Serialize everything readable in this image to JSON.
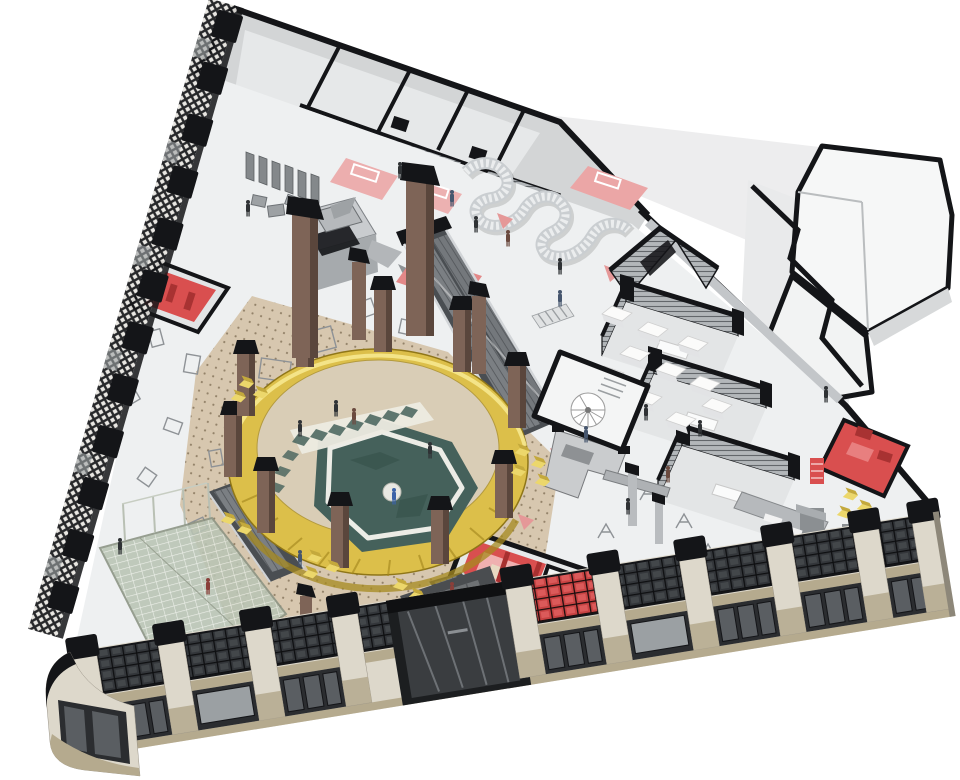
{
  "scene": {
    "type": "axonometric-architectural-cutaway",
    "description": "Aerial axonometric cutaway rendering of a wedge-shaped department store floor: a central golden circular atrium drum with a sunken teal marble pool court, brick piers, escalators, grey slatted fitting rooms, red accent rooms, serpentine display wall, glass canopy over a cafe corner, art-deco stone facade with black grid windows, and many tiny shoppers.",
    "view": "isometric from above",
    "background": "white"
  },
  "palette": {
    "cut_black": "#141518",
    "floor_light": "#eef0f1",
    "floor_mid": "#e0e2e4",
    "wall_gray": "#c6c9cc",
    "wall_dark": "#8f9396",
    "stone_light": "#ddd8cb",
    "stone_base": "#b5aa8e",
    "storefront_dark": "#2b2d30",
    "glass_pane": "#5a5e62",
    "brass_gold": "#dcbf4a",
    "gold_shade": "#a5891f",
    "gold_light": "#f6e88f",
    "court_beige": "#d9cdb6",
    "pool_teal": "#45615b",
    "pool_dark": "#36504a",
    "walk_white": "#edebe2",
    "accent_red": "#d94f4f",
    "deep_red": "#a83232",
    "soft_pink": "#eba6a6",
    "carpet_beige": "#d6c5ab",
    "carpet_dot": "#7c6a50",
    "pillar_brown": "#7e6457",
    "pillar_dark": "#5a463c",
    "chair_yellow": "#ecd76b",
    "canopy_glass": "#b9c4b4",
    "esc_dark": "#4a4e52",
    "esc_step": "#7b7f83",
    "people_dark": "#2f3235"
  },
  "features": {
    "atrium": "central golden drum balcony over sunken teal pool court",
    "back_of_house": "grey service rooms with black cut walls along top edge",
    "annex": "white-roofed annex volumes at upper right",
    "facade": "art-deco stone piers with black gridded windows along lower street edge",
    "parapet": "black crenellated window lattice along left street edge",
    "departments": "three slatted grey fitting-room pods stepping along the right side",
    "red_rooms": "red-floored lounge and fitting suites (4 locations)",
    "canopy": "sloped glass canopy over corner cafe at lower left"
  },
  "counts": {
    "facade_bays": 10,
    "facade_piers": 10,
    "atrium_columns": 10,
    "tall_piers": 2,
    "department_pods": 3,
    "people_visible": 30
  }
}
